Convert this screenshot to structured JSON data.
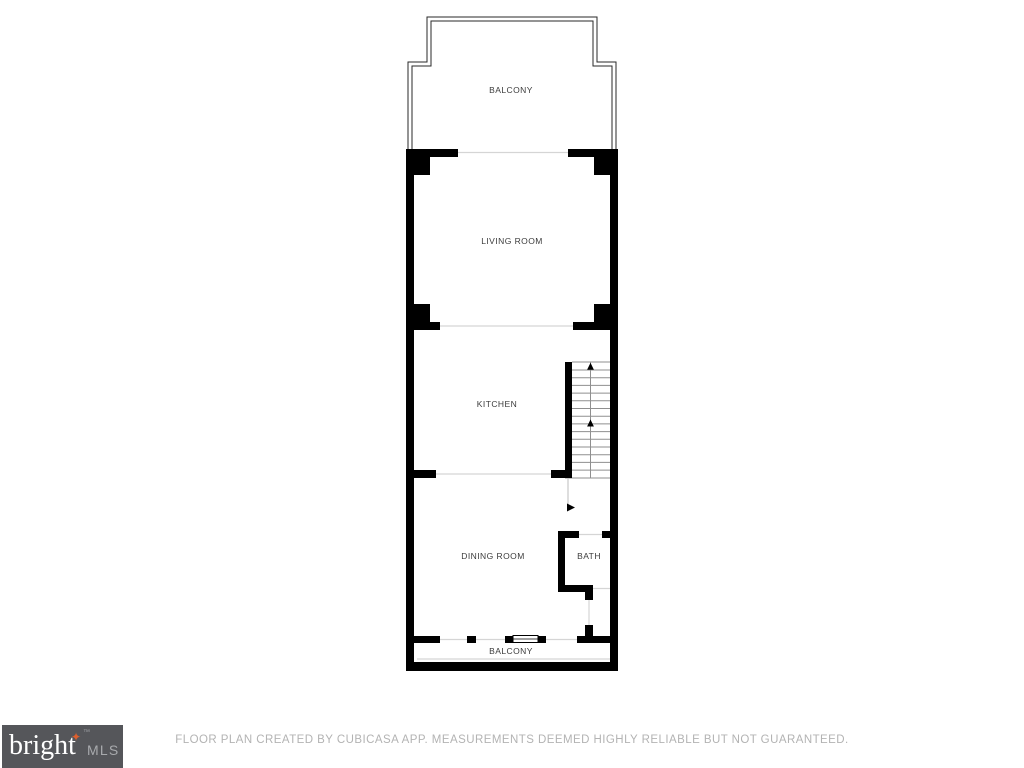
{
  "floor_plan": {
    "rooms": {
      "balcony_top": {
        "label": "BALCONY"
      },
      "living_room": {
        "label": "LIVING ROOM"
      },
      "kitchen": {
        "label": "KITCHEN"
      },
      "dining_room": {
        "label": "DINING ROOM"
      },
      "bath": {
        "label": "BATH"
      },
      "balcony_bottom": {
        "label": "BALCONY"
      }
    }
  },
  "footer": {
    "disclaimer": "FLOOR PLAN CREATED BY CUBICASA APP. MEASUREMENTS DEEMED HIGHLY RELIABLE BUT NOT GUARANTEED."
  },
  "logo": {
    "brand": "bright",
    "trademark": "™",
    "suffix": "MLS",
    "sparkle": "✦"
  },
  "colors": {
    "wall": "#000000",
    "opening_line": "#d5d5d5",
    "tread_line": "#8f8f8f",
    "railing_line": "#2a2a2a",
    "label_text": "#3c3c3c",
    "footer_text": "#b3b3b3",
    "logo_bg": "#55565a",
    "logo_brand": "#ffffff",
    "logo_mls": "#a8aaad",
    "logo_sparkle": "#dd5f2d"
  }
}
